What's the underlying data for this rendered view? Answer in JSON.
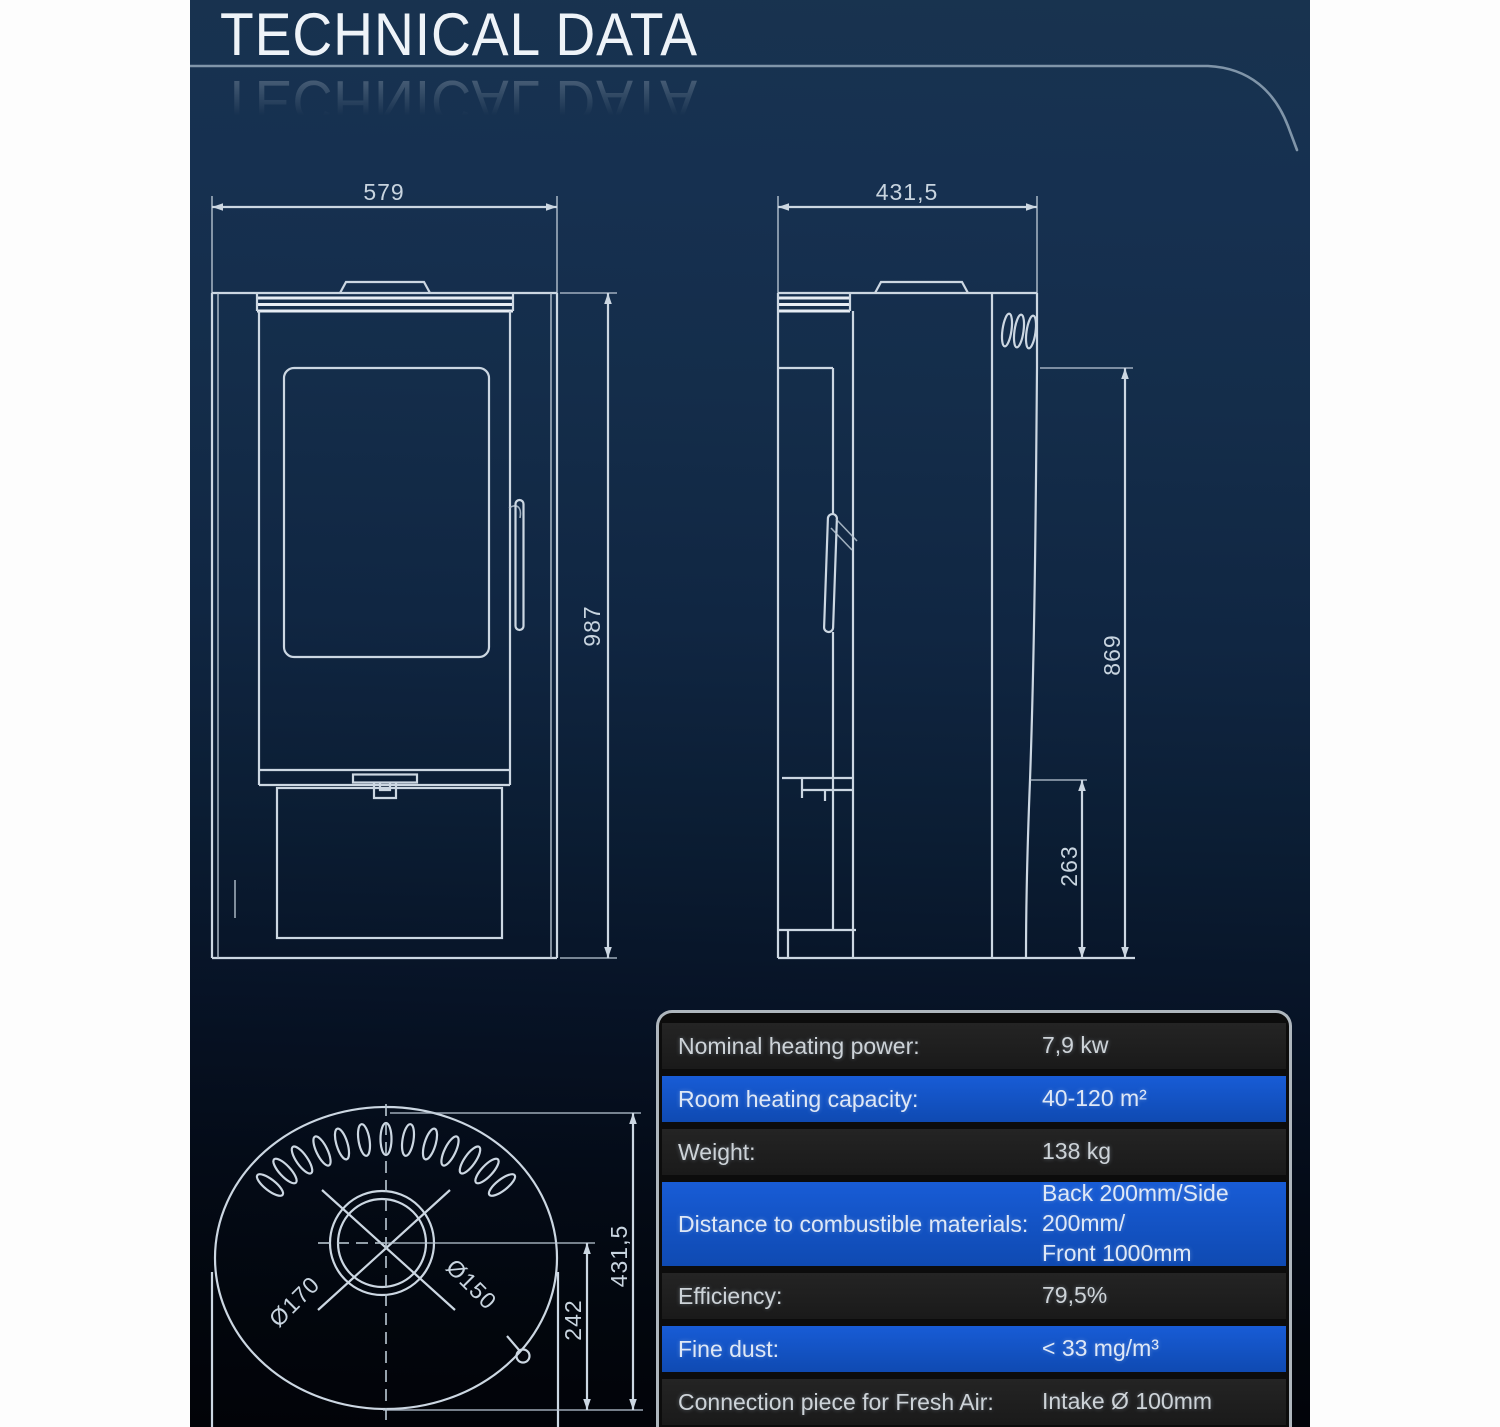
{
  "page": {
    "title": "TECHNICAL DATA"
  },
  "drawings": {
    "front_view": {
      "width": "579",
      "height": "987"
    },
    "side_view": {
      "depth": "431,5",
      "height": "869",
      "plinth_height": "263"
    },
    "top_view": {
      "depth": "431,5",
      "flue_offset": "242",
      "outer_diameter": "Ø170",
      "flue_diameter": "Ø150"
    }
  },
  "spec_table": {
    "rows": [
      {
        "label": "Nominal heating power:",
        "value": "7,9 kw"
      },
      {
        "label": "Room heating capacity:",
        "value": "40-120 m²"
      },
      {
        "label": "Weight:",
        "value": "138 kg"
      },
      {
        "label": "Distance to combustible materials:",
        "value": "Back 200mm/Side 200mm/\nFront 1000mm"
      },
      {
        "label": "Efficiency:",
        "value": "79,5%"
      },
      {
        "label": "Fine dust:",
        "value": "< 33 mg/m³"
      },
      {
        "label": "Connection piece for Fresh Air:",
        "value": "Intake Ø 100mm"
      }
    ]
  },
  "colors": {
    "background_navy": "#16314f",
    "row_highlight_blue": "#1254c8",
    "row_dark": "#1d1d1d",
    "drawing_line": "#ccd7e2",
    "page_margin": "#fdfdfd"
  }
}
